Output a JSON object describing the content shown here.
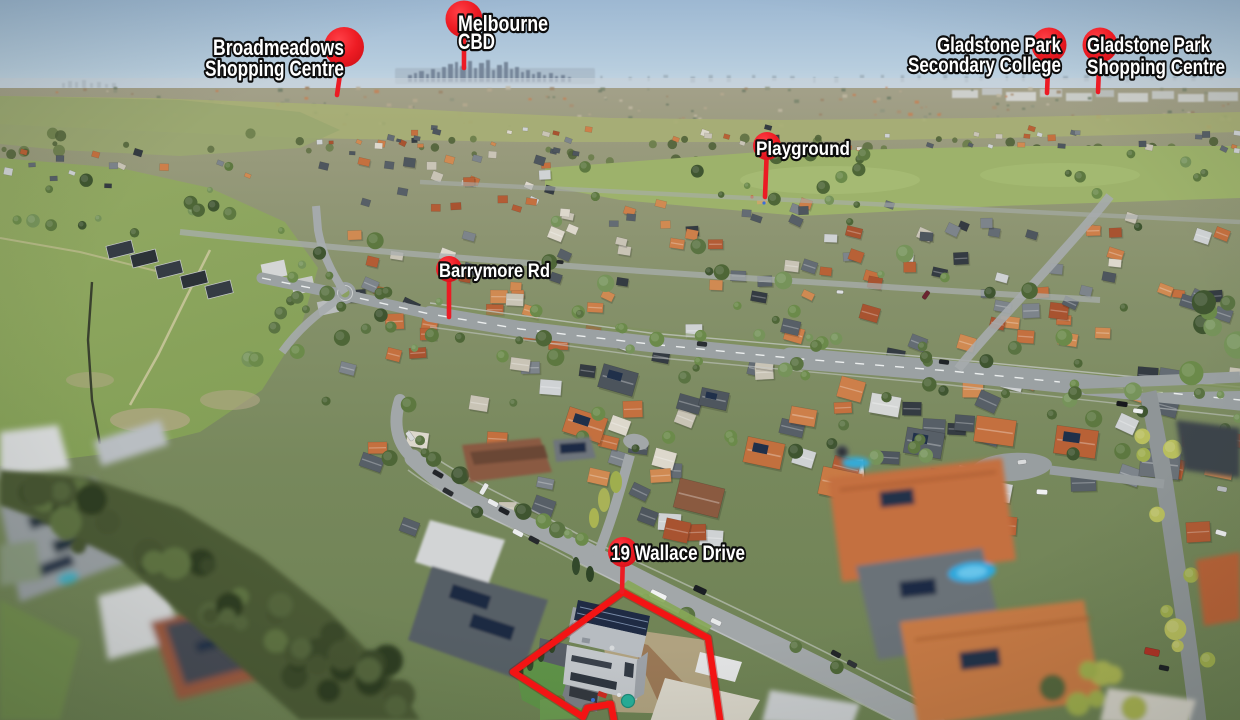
{
  "title": "19 Wallace Drive",
  "colors": {
    "pin": "#ec1b24",
    "pin_dark": "#cf1016",
    "boundary": "#f31414",
    "label_fill": "#ffffff",
    "label_stroke": "#0d0d0d",
    "sky": "#9db8d2"
  },
  "markers": [
    {
      "id": "broadmeadows-shopping-centre",
      "lines": [
        "Broadmeadows",
        "Shopping Centre"
      ],
      "pin": {
        "cx": 344,
        "cy": 47,
        "r": 20,
        "stem_x": 337,
        "stem_y": 95
      },
      "text": {
        "x": 344,
        "anchor": "end",
        "size": 22,
        "baselines": [
          55,
          76
        ],
        "lengths": [
          131,
          139
        ]
      }
    },
    {
      "id": "melbourne-cbd",
      "lines": [
        "Melbourne",
        "CBD"
      ],
      "pin": {
        "cx": 464,
        "cy": 19,
        "r": 18.5,
        "stem_x": 464,
        "stem_y": 68
      },
      "text": {
        "x": 458,
        "anchor": "start",
        "size": 22,
        "baselines": [
          31,
          49
        ],
        "lengths": [
          90,
          37
        ]
      }
    },
    {
      "id": "gladstone-park-secondary-college",
      "lines": [
        "Gladstone Park",
        "Secondary College"
      ],
      "pin": {
        "cx": 1049,
        "cy": 45,
        "r": 17.5,
        "stem_x": 1047,
        "stem_y": 93
      },
      "text": {
        "x": 1061,
        "anchor": "end",
        "size": 21,
        "baselines": [
          52,
          72
        ],
        "lengths": [
          124,
          153
        ]
      }
    },
    {
      "id": "gladstone-park-shopping-centre",
      "lines": [
        "Gladstone Park",
        "Shopping Centre"
      ],
      "pin": {
        "cx": 1100,
        "cy": 45,
        "r": 17.5,
        "stem_x": 1098,
        "stem_y": 92
      },
      "text": {
        "x": 1087,
        "anchor": "start",
        "size": 21,
        "baselines": [
          52,
          74
        ],
        "lengths": [
          123,
          138
        ]
      }
    },
    {
      "id": "playground",
      "lines": [
        "Playground"
      ],
      "pin": {
        "cx": 767,
        "cy": 146,
        "r": 14,
        "stem_x": 765,
        "stem_y": 197
      },
      "text": {
        "x": 756,
        "anchor": "start",
        "size": 19,
        "baselines": [
          155
        ],
        "lengths": [
          94
        ]
      }
    },
    {
      "id": "barrymore-rd",
      "lines": [
        "Barrymore Rd"
      ],
      "pin": {
        "cx": 449,
        "cy": 269,
        "r": 13,
        "stem_x": 449,
        "stem_y": 317
      },
      "text": {
        "x": 439,
        "anchor": "start",
        "size": 19.5,
        "baselines": [
          277
        ],
        "lengths": [
          111
        ]
      }
    },
    {
      "id": "19-wallace-drive",
      "lines": [
        "19 Wallace Drive"
      ],
      "pin": {
        "cx": 623,
        "cy": 552,
        "r": 15,
        "stem_x": 622,
        "stem_y": 592
      },
      "text": {
        "x": 611,
        "anchor": "start",
        "size": 21,
        "baselines": [
          560
        ],
        "lengths": [
          134
        ]
      }
    }
  ],
  "property": {
    "address": "19 Wallace Drive",
    "boundary_path": "M 721,726 L 708,638 L 623,592 L 513,672 L 583,717 L 587,708 L 611,704 L 615,726"
  }
}
